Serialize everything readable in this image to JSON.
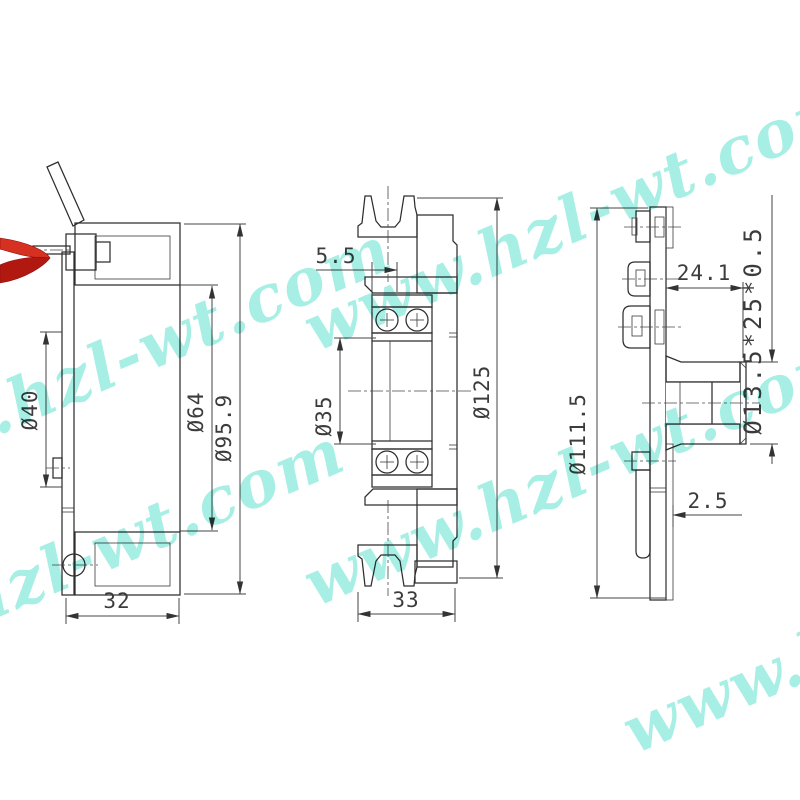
{
  "watermark": {
    "text": "www.hzl-wt.com",
    "color": "#6ce4d3"
  },
  "logo": {
    "name": "red-ribbon-logo",
    "color": "#d63020"
  },
  "views": {
    "left": {
      "name": "coil-housing-section",
      "dims": {
        "bore": "Ø40",
        "mid": "Ø64",
        "outer": "Ø95.9",
        "width": "32"
      }
    },
    "middle": {
      "name": "pulley-section",
      "dims": {
        "offset": "5.5",
        "bore": "Ø35",
        "outer": "Ø125",
        "width": "33"
      }
    },
    "right": {
      "name": "hub-plate-section",
      "dims": {
        "outer": "Ø111.5",
        "depth": "24.1",
        "spec": "Ø13.5*25*0.5",
        "thickness": "2.5"
      }
    }
  }
}
